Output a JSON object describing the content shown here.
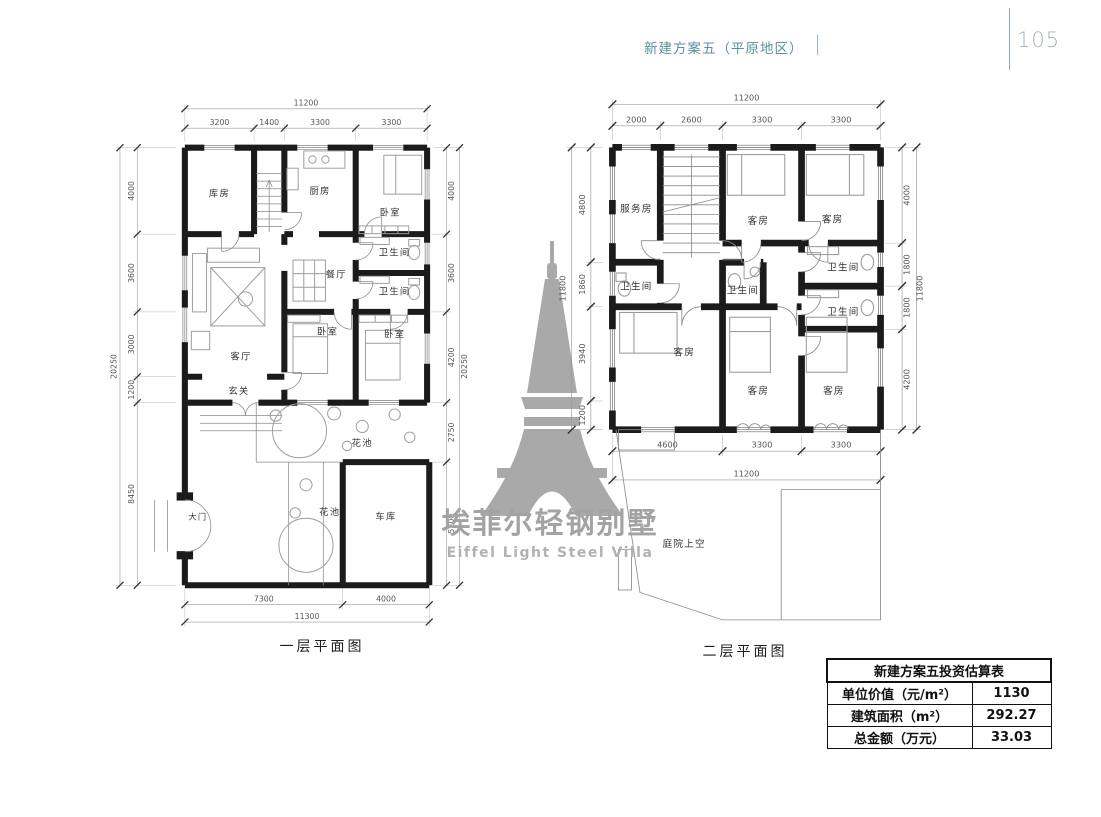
{
  "header": {
    "title": "新建方案五（平原地区）",
    "page_number": "105"
  },
  "watermark": {
    "title_cn": "埃菲尔轻钢别墅",
    "title_en": "Eiffel Light Steel Villa",
    "tower_color": "#a9a9a9"
  },
  "floor1": {
    "caption": "一层平面图",
    "rooms": {
      "storage": "库房",
      "kitchen": "厨房",
      "bedroom1": "卧室",
      "bath1": "卫生间",
      "bath2": "卫生间",
      "dining": "餐厅",
      "living": "客厅",
      "bedroom2": "卧室",
      "bedroom3": "卧室",
      "entry": "玄关",
      "flower_bed1": "花池",
      "flower_bed2": "花池",
      "garage": "车库",
      "gate": "大门"
    },
    "dims": {
      "top_total": "11200",
      "top": [
        "3200",
        "1400",
        "3300",
        "3300"
      ],
      "left_total": "20250",
      "left": [
        "4000",
        "3600",
        "3000",
        "1200",
        "8450"
      ],
      "right_total": "20250",
      "right": [
        "4000",
        "3600",
        "4200",
        "2750",
        "5700"
      ],
      "bottom_total": "11300",
      "bottom": [
        "7300",
        "4000"
      ]
    }
  },
  "floor2": {
    "caption": "二层平面图",
    "rooms": {
      "service": "服务房",
      "guest1": "客房",
      "guest2": "客房",
      "bath_left": "卫生间",
      "bath_center": "卫生间",
      "bath_right1": "卫生间",
      "bath_right2": "卫生间",
      "guest3": "客房",
      "guest4": "客房",
      "guest5": "客房",
      "courtyard": "庭院上空"
    },
    "dims": {
      "top_total": "11200",
      "top": [
        "2000",
        "2600",
        "3300",
        "3300"
      ],
      "left_total": "11800",
      "left": [
        "4800",
        "1860",
        "3940",
        "1200"
      ],
      "right_total": "11800",
      "right": [
        "4000",
        "1800",
        "1800",
        "4200"
      ],
      "bottom_total": "11200",
      "bottom": [
        "4600",
        "3300",
        "3300"
      ]
    }
  },
  "estimate_table": {
    "title": "新建方案五投资估算表",
    "rows": [
      {
        "label": "单位价值（元/m²）",
        "value": "1130"
      },
      {
        "label": "建筑面积（m²）",
        "value": "292.27"
      },
      {
        "label": "总金额（万元）",
        "value": "33.03"
      }
    ]
  },
  "colors": {
    "header_text": "#5b8fa0",
    "page_number": "#a9b2b8",
    "plan_line": "#1b1b1b",
    "watermark": "#a9a9a9"
  }
}
